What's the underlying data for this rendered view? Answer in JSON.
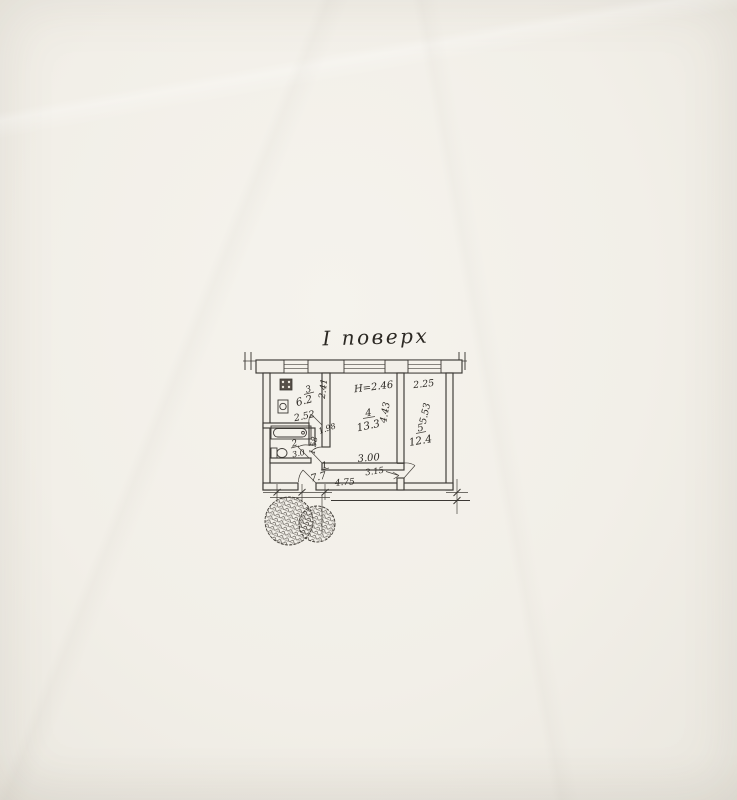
{
  "document": {
    "title": "І поверх"
  },
  "plan": {
    "paper_color": "#f2efe8",
    "ink_color": "#3b3834",
    "height_note": "Н=2.46",
    "rooms": [
      {
        "number": "1",
        "area": "7.7"
      },
      {
        "number": "2",
        "area": "3.0"
      },
      {
        "number": "3",
        "area": "6.2"
      },
      {
        "number": "4",
        "area": "13.3"
      },
      {
        "number": "5",
        "area": "12.4"
      }
    ],
    "dimensions": {
      "kitchen_width": "2.52",
      "kitchen_depth": "2.41",
      "nook_width": "1.98",
      "nook_depth": "1.58",
      "room4_width": "3.00",
      "room4_width_outer": "3.15",
      "room4_depth": "4.43",
      "room5_width": "2.25",
      "room5_depth": "5.53",
      "hall_width": "4.75"
    }
  }
}
